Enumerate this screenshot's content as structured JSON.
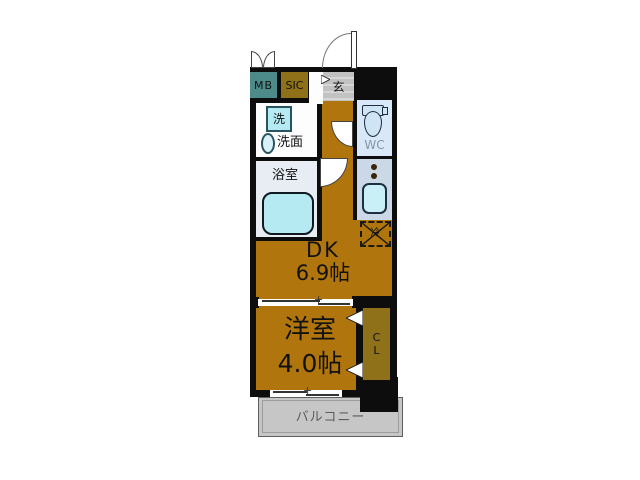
{
  "floorplan": {
    "rooms": {
      "mb_label": "MB",
      "sic_label": "SIC",
      "entrance_label": "玄",
      "washer_label": "洗",
      "washroom_label": "洗面",
      "bathroom_label": "浴室",
      "toilet_label": "WC",
      "fridge_label": "冷",
      "dk_label": "DK",
      "dk_size": "6.9帖",
      "bedroom_label": "洋室",
      "bedroom_size": "4.0帖",
      "closet_label_top": "C",
      "closet_label_bottom": "L",
      "balcony_label": "バルコニー"
    },
    "colors": {
      "wall": "#0d0d0d",
      "wood_floor": "#b1750e",
      "meter_box_teal": "#4d8a8a",
      "closet_olive": "#8e7119",
      "entrance_tile_gray": "#c2c2c2",
      "bathroom_floor": "#e7edf3",
      "fixture_cyan": "#b5eaf2",
      "wc_floor": "#d9e8f8",
      "kitchen_counter": "#cbd9e7",
      "balcony_gray": "#c6c6c6"
    }
  }
}
